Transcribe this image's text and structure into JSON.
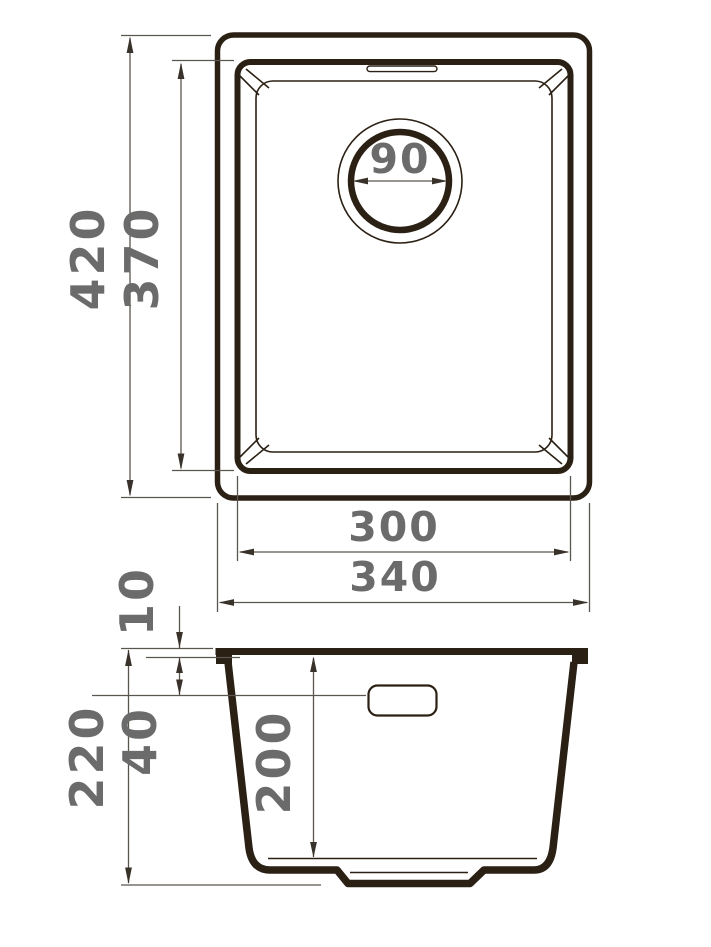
{
  "title": "Kitchen sink dimensional drawing",
  "colors": {
    "outline": "#2b2014",
    "dimension": "#5a554e",
    "arrow": "#38322b",
    "label": "#6b6b6b",
    "background": "#ffffff"
  },
  "top_view": {
    "labels": {
      "outer_height": "420",
      "inner_height": "370",
      "drain_diameter": "90",
      "inner_width": "300",
      "outer_width": "340"
    }
  },
  "side_view": {
    "labels": {
      "rim_height": "10",
      "overflow_drop": "40",
      "total_height": "220",
      "bowl_depth": "200"
    }
  }
}
